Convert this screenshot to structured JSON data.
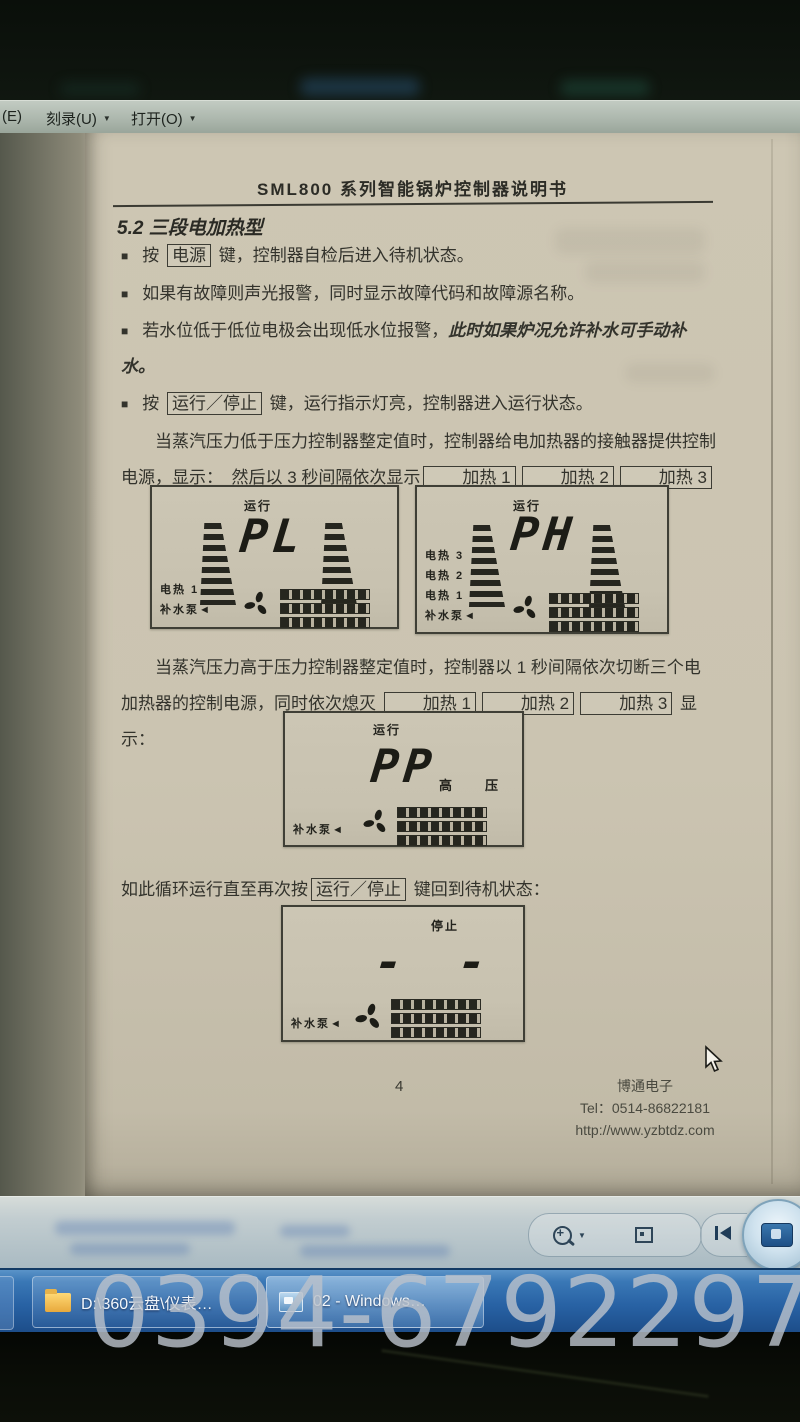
{
  "menu": {
    "email_partial": "(E)",
    "burn": "刻录(U)",
    "open": "打开(O)",
    "caret": "▼"
  },
  "doc": {
    "header_title": "SML800 系列智能锅炉控制器说明书",
    "section_title": "5.2 三段电加热型",
    "bullet1_pre": "按",
    "key_power": "电源",
    "bullet1_post": "键，控制器自检后进入待机状态。",
    "bullet2": "如果有故障则声光报警，同时显示故障代码和故障源名称。",
    "bullet3_pre": "若水位低于低位电极会出现低水位报警，",
    "bullet3_italic": "此时如果炉况允许补水可手动补水。",
    "bullet4_pre": "按",
    "key_run_stop": "运行／停止",
    "bullet4_post": "键，运行指示灯亮，控制器进入运行状态。",
    "para1_a": "当蒸汽压力低于压力控制器整定值时，控制器给电加热器的接触器提供控制电源，显示：　然后以 3 秒间隔依次显示",
    "heat1": "加热 1",
    "heat2": "加热 2",
    "heat3": "加热 3",
    "para2_a": "当蒸汽压力高于压力控制器整定值时，控制器以 1 秒间隔依次切断三个电加热器的控制电源，同时依次熄灭",
    "para2_b": "显示：",
    "line3_pre": "如此循环运行直至再次按",
    "line3_post": "键回到待机状态：",
    "footer_page": "4",
    "footer_company": "博通电子",
    "footer_tel": "Tel：0514-86822181",
    "footer_url": "http://www.yzbtdz.com"
  },
  "lcds": [
    {
      "status": "运行",
      "main": "PL",
      "rows": [
        "电热 1",
        "补水泵◄"
      ]
    },
    {
      "status": "运行",
      "main": "PH",
      "rows": [
        "电热 3",
        "电热 2",
        "电热 1",
        "补水泵◄"
      ]
    },
    {
      "status": "运行",
      "main": "PP",
      "side_label": "高　压",
      "rows": [
        "补水泵◄"
      ]
    },
    {
      "status": "停止",
      "main": "- -",
      "rows": [
        "补水泵◄"
      ]
    }
  ],
  "taskbar": {
    "button1": "D:\\360云盘\\仪表…",
    "button2": "02 - Windows…"
  },
  "watermark": "0394-6792297"
}
